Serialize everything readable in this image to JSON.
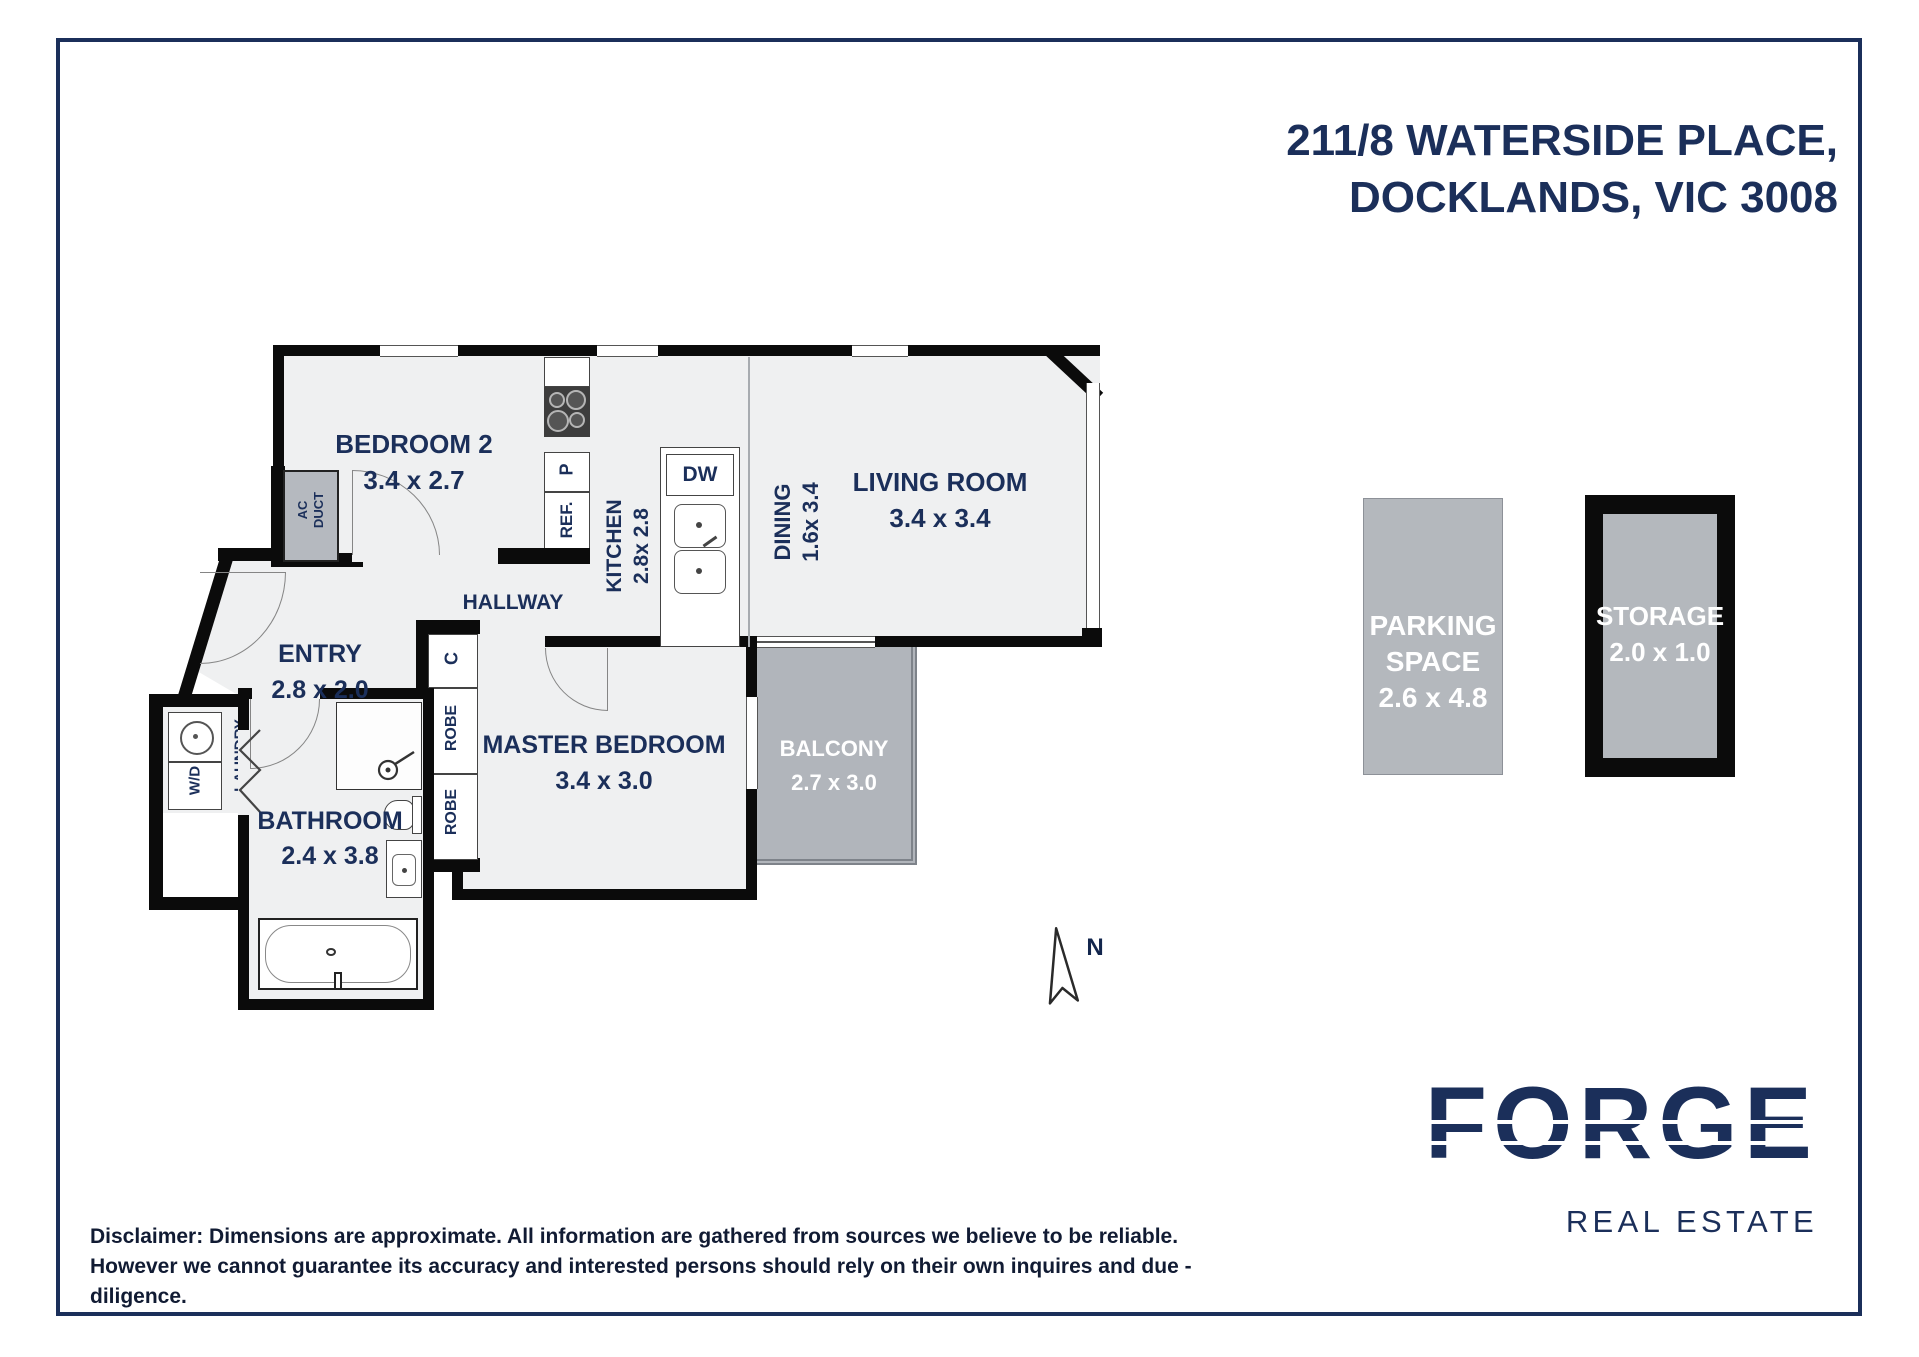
{
  "page": {
    "title_line1": "211/8 WATERSIDE PLACE,",
    "title_line2": "DOCKLANDS, VIC 3008"
  },
  "rooms": {
    "bedroom2": {
      "name": "BEDROOM 2",
      "dims": "3.4 x 2.7"
    },
    "kitchen": {
      "name": "KITCHEN",
      "dims": "2.8x 2.8"
    },
    "dining": {
      "name": "DINING",
      "dims": "1.6x 3.4"
    },
    "living": {
      "name": "LIVING ROOM",
      "dims": "3.4 x 3.4"
    },
    "hallway": {
      "name": "HALLWAY"
    },
    "entry": {
      "name": "ENTRY",
      "dims": "2.8 x 2.0"
    },
    "master": {
      "name": "MASTER BEDROOM",
      "dims": "3.4 x 3.0"
    },
    "bathroom": {
      "name": "BATHROOM",
      "dims": "2.4 x 3.8"
    },
    "balcony": {
      "name": "BALCONY",
      "dims": "2.7 x 3.0"
    },
    "laundry": {
      "name": "LAUNDRY"
    },
    "parking": {
      "line1": "PARKING",
      "line2": "SPACE",
      "dims": "2.6 x 4.8"
    },
    "storage": {
      "name": "STORAGE",
      "dims": "2.0 x 1.0"
    }
  },
  "fixtures": {
    "wd": "W/D",
    "ac_line1": "AC",
    "ac_line2": "DUCT",
    "ref": "REF.",
    "pantry": "P",
    "dw": "DW",
    "cupboard": "C",
    "robe1": "ROBE",
    "robe2": "ROBE"
  },
  "compass": {
    "label": "N"
  },
  "branding": {
    "logo": "FORGE",
    "tagline": "REAL ESTATE"
  },
  "disclaimer": {
    "line1": "Disclaimer: Dimensions are approximate. All information are gathered from sources we believe to be reliable.",
    "line2": "However we cannot guarantee its accuracy and interested persons should rely on their own inquires and due - diligence."
  },
  "colors": {
    "navy": "#1b2f5a",
    "wall": "#0b0b0b",
    "floor": "#eff0f1",
    "gray_area": "#b4b8bd"
  }
}
